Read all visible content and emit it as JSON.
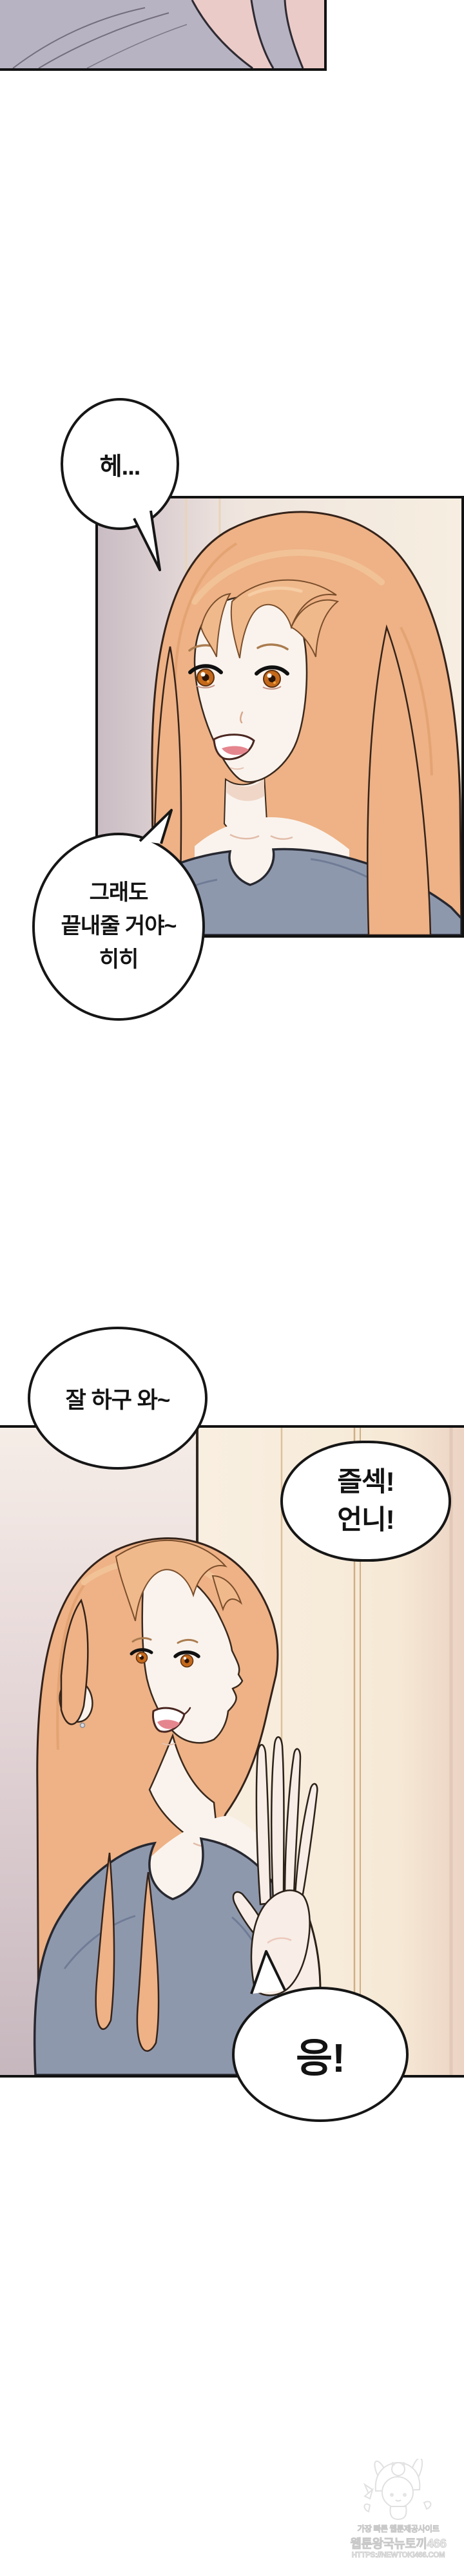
{
  "page": {
    "type": "webtoon-episode-page",
    "background": "#ffffff"
  },
  "bubbles": {
    "b1": {
      "line1": "헤..."
    },
    "b2": {
      "line1": "그래도",
      "line2": "끝내줄 거야~",
      "line3": "히히"
    },
    "b3": {
      "line1": "잘 하구 와~"
    },
    "b4": {
      "line1": "즐섹!",
      "line2": "언니!"
    },
    "b5": {
      "line1": "응!"
    }
  },
  "watermark": {
    "line1": "가장 빠른 웹툰제공사이트",
    "line2": "웹툰왕국뉴토끼466",
    "line3": "HTTPS://NEWTOKI466.COM"
  },
  "colors": {
    "panel_border": "#121212",
    "bubble_border": "#161616",
    "hair": "#eeb286",
    "hair_outline": "#33221a",
    "skin": "#faf3ed",
    "shirt_blue_gray": "#8e98ad",
    "door_cream": "#f9efe1",
    "wall_mauve": "#c6b7be",
    "fragment_lavender": "#b7b3c2",
    "fragment_pink": "#ebcbc8",
    "eye_iris": "#c4691b",
    "tongue": "#e5868f",
    "watermark_gray": "#c9c9c9"
  }
}
